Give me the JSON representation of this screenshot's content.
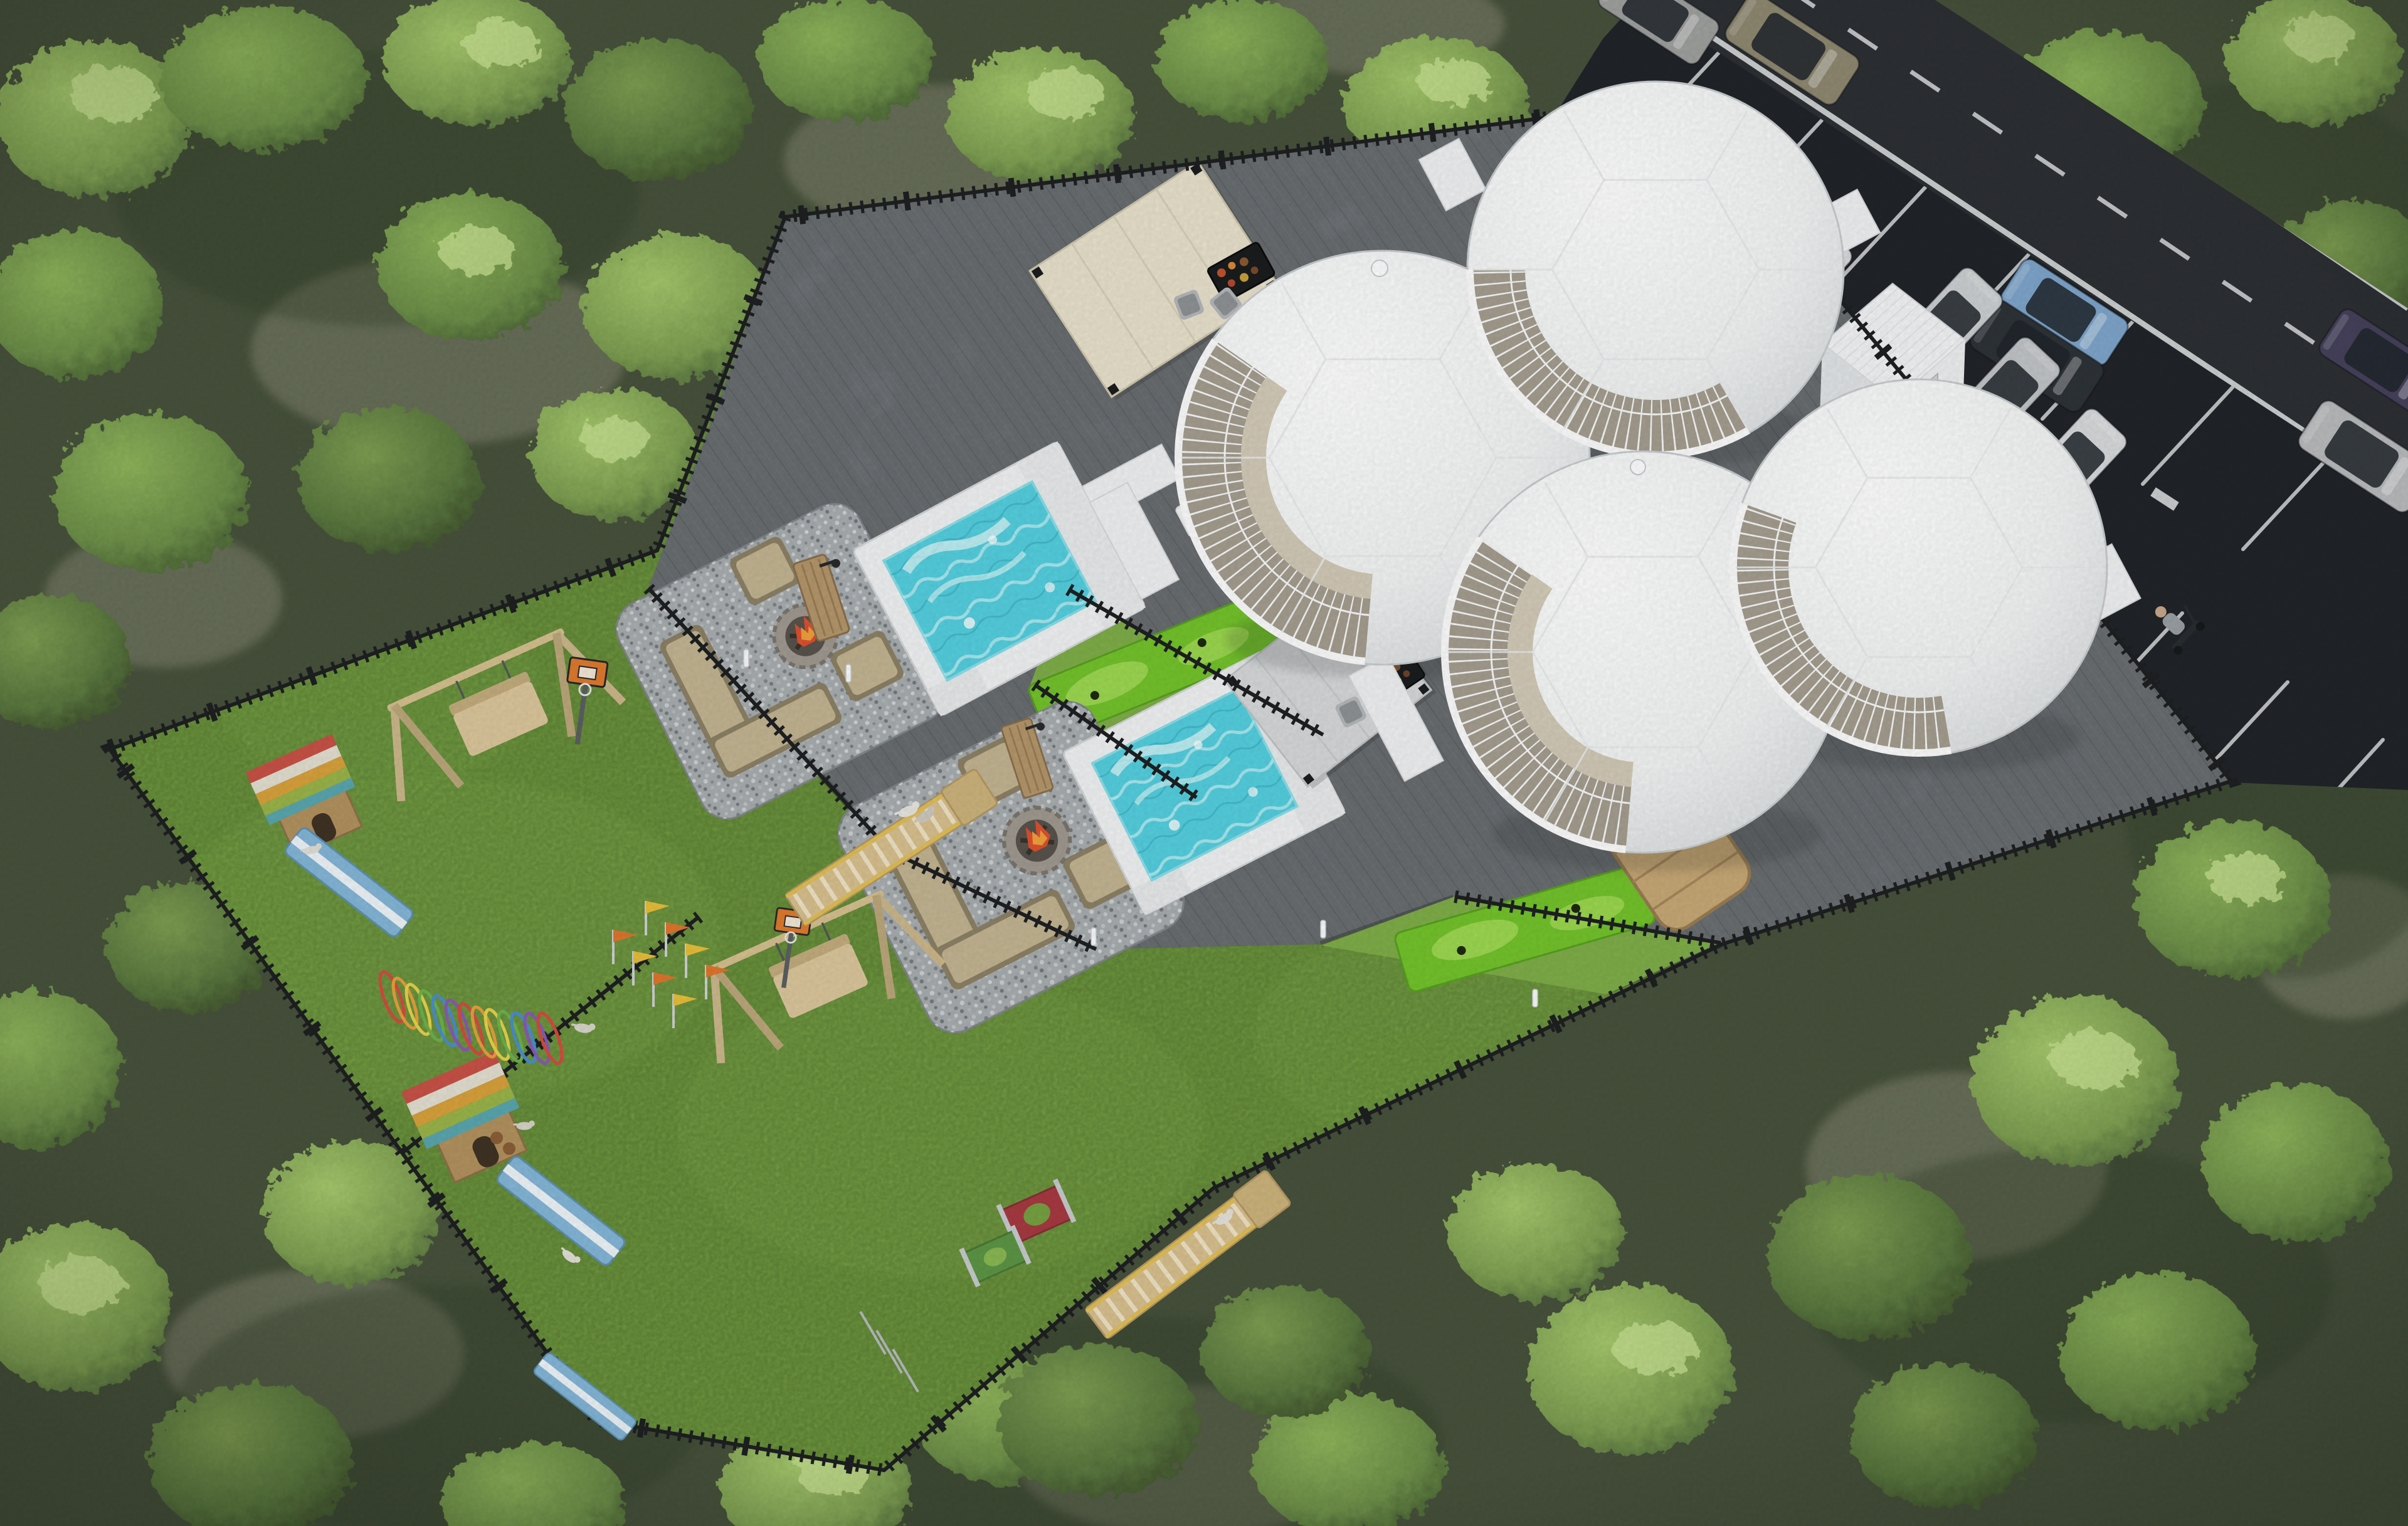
{
  "palette": {
    "forest_base": "#47523c",
    "forest_shadow": "#333f2c",
    "ground_patch": "#70755f",
    "tree_light": "#a6c96d",
    "tree_mid": "#7fa052",
    "tree_dark": "#597440",
    "tree_accent": "#c9e393",
    "lawn": "#76a243",
    "lawn_bright": "#82b14e",
    "putting": "#74c32c",
    "putting_light": "#a2dc55",
    "gravel": "#a9aeb1",
    "deck": "#7b8084",
    "plank": "#5e6368",
    "fence": "#1e2022",
    "road": "#2d3034",
    "parking": "#212429",
    "marking": "#e9ebec",
    "dome": "#f6f7f8",
    "dome_edge": "#c9cdcf",
    "glazing": "#a59e90",
    "pool": "#f2f3f4",
    "water": "#55d0e0",
    "foam": "#e8fbfc",
    "canopy_cream": "#e9e2cd",
    "canopy_gray": "#d7d9da",
    "frame": "#1b1d1f",
    "sofa": "#c3b592",
    "sofa_dark": "#8d8266",
    "stone": "#a09a91",
    "fire": "#dd5130",
    "fire_glow": "#f2a13c",
    "wood": "#c8a976",
    "wood_light": "#dcc394",
    "cabin": "#f4f5f6",
    "agility_yellow": "#e3c055",
    "agility_orange": "#e0762e",
    "ramp_blue": "#85b7d9",
    "hoops": [
      "#d94b3f",
      "#e8a13c",
      "#e8d44a",
      "#6cb44e",
      "#4a8fd4",
      "#8a5bb8"
    ],
    "roof_stripes": [
      "#c95247",
      "#e4e0d2",
      "#d9a23c",
      "#9ab54a",
      "#5aa7b0"
    ]
  },
  "inventory": {
    "geodesic_domes": 4,
    "utility_cabins": 2,
    "plunge_pools": 2,
    "pergolas": 2,
    "bbq_grills": 2,
    "fire_pit_lounges": 2,
    "barrel_saunas": 2,
    "putting_greens": 2,
    "dog_play_lawns": 2,
    "dog_houses": 2,
    "swing_benches": 2,
    "basketball_hoops": 2,
    "dog_walk_ramps": 2,
    "balance_ramps": 3,
    "agility_hoop_tunnel_rings": 13,
    "jump_panels": 2,
    "outdoor_showers": 2,
    "deck_bollard_lights": 6,
    "parked_cars": 5,
    "cars_on_road": 6,
    "scooter_riders": 1,
    "dogs": 7
  },
  "vehicles": {
    "road": [
      {
        "color": "#8f8971"
      },
      {
        "color": "#9fa19f"
      },
      {
        "color": "#7fa6cc"
      },
      {
        "color": "#2e3338"
      },
      {
        "color": "#46425c"
      },
      {
        "color": "#b9bbbd"
      }
    ],
    "parked": [
      {
        "color": "#c9ccce"
      },
      {
        "color": "#d6d8da"
      },
      {
        "color": "#cdd0d2"
      },
      {
        "color": "#c2c5c8"
      },
      {
        "color": "#d8dadc"
      }
    ]
  }
}
